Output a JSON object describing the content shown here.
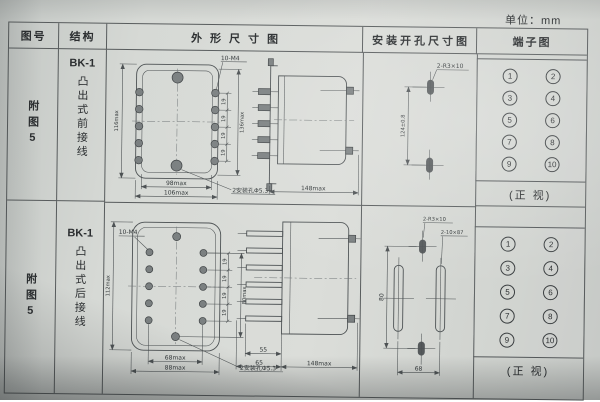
{
  "page": {
    "unit": "单位：mm",
    "headers": {
      "fig": "图号",
      "structure": "结构",
      "outline": "外形尺寸图",
      "install": "安装开孔尺寸图",
      "terminal": "端子图"
    }
  },
  "rows": [
    {
      "fig": "附图5",
      "model": "BK-1",
      "structure": "凸出式前接线",
      "outline": {
        "screw_label": "10-M4",
        "hole_label": "2安装孔Φ5.3",
        "height_left": "116max",
        "height_right": "136max",
        "pitch": "19",
        "width_inner": "98max",
        "width_outer": "106max",
        "depth": "148max"
      },
      "install": {
        "slot_label": "2-R3×10",
        "pitch_v": "124±0.8"
      },
      "terminal": {
        "numbers": [
          "1",
          "2",
          "3",
          "4",
          "5",
          "6",
          "7",
          "8",
          "9",
          "10"
        ],
        "caption": "(正 视)"
      }
    },
    {
      "fig": "附图5",
      "model": "BK-1",
      "structure": "凸出式后接线",
      "outline": {
        "screw_label": "10-M4",
        "hole_label": "2安装孔Φ5.3",
        "height_left": "112max",
        "height_right": "80max",
        "pitch": "19",
        "width_inner": "68max",
        "width_outer": "88max",
        "pin_len": "55",
        "pin_overall": "65",
        "depth": "148max"
      },
      "install": {
        "slot_small_label": "2-R3×10",
        "slot_big_label": "2-10×87",
        "pitch_v": "80",
        "pitch_h": "68"
      },
      "terminal": {
        "numbers": [
          "1",
          "2",
          "3",
          "4",
          "5",
          "6",
          "7",
          "8",
          "9",
          "10"
        ],
        "caption": "(正 视)"
      }
    }
  ]
}
